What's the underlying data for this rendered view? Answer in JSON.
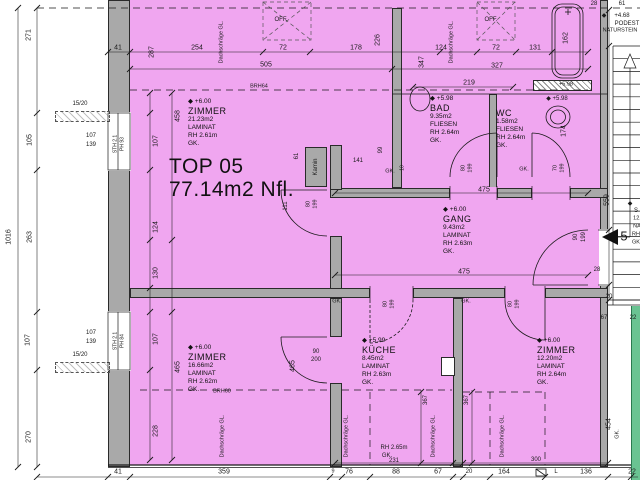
{
  "title": {
    "line1": "TOP 05",
    "line2": "77.14m2 Nfl."
  },
  "rooms": [
    {
      "id": "zimmer-nw",
      "level": "+6.00",
      "name": "ZIMMER",
      "area": "21.23m2",
      "floor": "LAMINAT",
      "rh": "RH 2.61m",
      "ceiling": "GK.",
      "x": 188,
      "y": 98
    },
    {
      "id": "bad",
      "level": "+5.98",
      "name": "BAD",
      "area": "9.35m2",
      "floor": "FLIESEN",
      "rh": "RH 2.64m",
      "ceiling": "GK.",
      "x": 430,
      "y": 95
    },
    {
      "id": "wc",
      "level": "",
      "name": "WC",
      "area": "1.58m2",
      "floor": "FLIESEN",
      "rh": "RH 2.64m",
      "ceiling": "GK.",
      "x": 496,
      "y": 108
    },
    {
      "id": "gang",
      "level": "+6.00",
      "name": "GANG",
      "area": "9.43m2",
      "floor": "LAMINAT",
      "rh": "RH 2.63m",
      "ceiling": "GK.",
      "x": 443,
      "y": 206
    },
    {
      "id": "zimmer-sw",
      "level": "+6.00",
      "name": "ZIMMER",
      "area": "16.66m2",
      "floor": "LAMINAT",
      "rh": "RH 2.62m",
      "ceiling": "GK.",
      "x": 188,
      "y": 344
    },
    {
      "id": "kueche",
      "level": "+5.99",
      "name": "KÜCHE",
      "area": "8.45m2",
      "floor": "LAMINAT",
      "rh": "RH 2.63m",
      "ceiling": "GK.",
      "x": 362,
      "y": 337
    },
    {
      "id": "zimmer-se",
      "level": "+6.00",
      "name": "ZIMMER",
      "area": "12.20m2",
      "floor": "LAMINAT",
      "rh": "RH 2.64m",
      "ceiling": "GK.",
      "x": 537,
      "y": 337
    }
  ],
  "stair": {
    "landing": "PODEST",
    "material": "NATURSTEIN",
    "level": "+4.68",
    "step_number": "5"
  },
  "colors": {
    "room_fill": "#f0a6f0",
    "wall": "#a9a9a9",
    "neighbor_strip": "#6ac392",
    "line": "#1a1a1a"
  },
  "labels": [
    {
      "t": "41",
      "x": 118,
      "y": 48
    },
    {
      "t": "287",
      "x": 152,
      "y": 52,
      "r": 1
    },
    {
      "t": "254",
      "x": 197,
      "y": 48
    },
    {
      "t": "72",
      "x": 283,
      "y": 48
    },
    {
      "t": "178",
      "x": 356,
      "y": 48
    },
    {
      "t": "226",
      "x": 378,
      "y": 40,
      "r": 1
    },
    {
      "t": "124",
      "x": 441,
      "y": 48
    },
    {
      "t": "72",
      "x": 496,
      "y": 48
    },
    {
      "t": "131",
      "x": 535,
      "y": 48
    },
    {
      "t": "505",
      "x": 266,
      "y": 65
    },
    {
      "t": "347",
      "x": 422,
      "y": 62,
      "r": 1
    },
    {
      "t": "327",
      "x": 497,
      "y": 66
    },
    {
      "t": "219",
      "x": 469,
      "y": 83
    },
    {
      "t": "28",
      "x": 594,
      "y": 4,
      "s": 6
    },
    {
      "t": "61",
      "x": 622,
      "y": 4,
      "s": 6
    },
    {
      "t": "162",
      "x": 566,
      "y": 38,
      "r": 1
    },
    {
      "t": "BRH64",
      "x": 259,
      "y": 87,
      "s": 5.5
    },
    {
      "t": "OFF.",
      "x": 281,
      "y": 20,
      "s": 6
    },
    {
      "t": "OFF.",
      "x": 491,
      "y": 20,
      "s": 6
    },
    {
      "t": "+5.98",
      "x": 566,
      "y": 85,
      "s": 5.5
    },
    {
      "t": "Dachschräge GL.",
      "x": 222,
      "y": 42,
      "r": 1,
      "s": 5.5
    },
    {
      "t": "Dachschräge GL.",
      "x": 452,
      "y": 42,
      "r": 1,
      "s": 5.5
    },
    {
      "t": "271",
      "x": 29,
      "y": 35,
      "r": 1
    },
    {
      "t": "105",
      "x": 30,
      "y": 140,
      "r": 1
    },
    {
      "t": "263",
      "x": 30,
      "y": 237,
      "r": 1
    },
    {
      "t": "107",
      "x": 28,
      "y": 340,
      "r": 1
    },
    {
      "t": "270",
      "x": 29,
      "y": 437,
      "r": 1
    },
    {
      "t": "1016",
      "x": 9,
      "y": 237,
      "r": 1
    },
    {
      "t": "15/20",
      "x": 80,
      "y": 104,
      "s": 6
    },
    {
      "t": "15/20",
      "x": 80,
      "y": 355,
      "s": 6
    },
    {
      "t": "107",
      "x": 91,
      "y": 136,
      "s": 6
    },
    {
      "t": "139",
      "x": 91,
      "y": 145,
      "s": 6
    },
    {
      "t": "107",
      "x": 91,
      "y": 333,
      "s": 6
    },
    {
      "t": "139",
      "x": 91,
      "y": 342,
      "s": 6
    },
    {
      "t": "STH 2.1",
      "x": 116,
      "y": 144,
      "r": 1,
      "s": 5
    },
    {
      "t": "PH 93",
      "x": 123,
      "y": 144,
      "r": 1,
      "s": 5
    },
    {
      "t": "STH 2.1",
      "x": 116,
      "y": 341,
      "r": 1,
      "s": 5
    },
    {
      "t": "PH 84",
      "x": 123,
      "y": 341,
      "r": 1,
      "s": 5
    },
    {
      "t": "458",
      "x": 178,
      "y": 116,
      "r": 1
    },
    {
      "t": "107",
      "x": 156,
      "y": 141,
      "r": 1
    },
    {
      "t": "124",
      "x": 156,
      "y": 227,
      "r": 1
    },
    {
      "t": "130",
      "x": 156,
      "y": 273,
      "r": 1
    },
    {
      "t": "107",
      "x": 156,
      "y": 339,
      "r": 1
    },
    {
      "t": "465",
      "x": 178,
      "y": 367,
      "r": 1
    },
    {
      "t": "228",
      "x": 156,
      "y": 431,
      "r": 1
    },
    {
      "t": "465",
      "x": 293,
      "y": 366,
      "r": 1
    },
    {
      "t": "Kamin",
      "x": 316,
      "y": 167,
      "r": 1,
      "s": 6
    },
    {
      "t": "61",
      "x": 297,
      "y": 156,
      "r": 1,
      "s": 6
    },
    {
      "t": "141",
      "x": 358,
      "y": 161,
      "s": 6
    },
    {
      "t": "99",
      "x": 381,
      "y": 150,
      "r": 1,
      "s": 6
    },
    {
      "t": "GK.",
      "x": 390,
      "y": 172,
      "s": 5.5
    },
    {
      "t": "111",
      "x": 286,
      "y": 206,
      "r": 1,
      "s": 6
    },
    {
      "t": "80",
      "x": 309,
      "y": 204,
      "r": 1,
      "s": 5.5
    },
    {
      "t": "199",
      "x": 316,
      "y": 204,
      "r": 1,
      "s": 5.5
    },
    {
      "t": "GK.",
      "x": 524,
      "y": 170,
      "s": 5.5
    },
    {
      "t": "10",
      "x": 403,
      "y": 168,
      "r": 1,
      "s": 5
    },
    {
      "t": "80",
      "x": 464,
      "y": 168,
      "r": 1,
      "s": 5.5
    },
    {
      "t": "199",
      "x": 471,
      "y": 168,
      "r": 1,
      "s": 5.5
    },
    {
      "t": "70",
      "x": 556,
      "y": 168,
      "r": 1,
      "s": 5.5
    },
    {
      "t": "199",
      "x": 563,
      "y": 168,
      "r": 1,
      "s": 5.5
    },
    {
      "t": "174",
      "x": 564,
      "y": 131,
      "r": 1
    },
    {
      "t": "◆ +5.98",
      "x": 557,
      "y": 99,
      "s": 6
    },
    {
      "t": "475",
      "x": 484,
      "y": 190
    },
    {
      "t": "475",
      "x": 464,
      "y": 272
    },
    {
      "t": "90",
      "x": 576,
      "y": 237,
      "r": 1,
      "s": 6
    },
    {
      "t": "199",
      "x": 584,
      "y": 237,
      "r": 1,
      "s": 6
    },
    {
      "t": "GK.",
      "x": 337,
      "y": 302,
      "s": 5.5
    },
    {
      "t": "GK.",
      "x": 466,
      "y": 302,
      "s": 5.5
    },
    {
      "t": "80",
      "x": 386,
      "y": 304,
      "r": 1,
      "s": 5.5
    },
    {
      "t": "199",
      "x": 393,
      "y": 304,
      "r": 1,
      "s": 5.5
    },
    {
      "t": "80",
      "x": 511,
      "y": 304,
      "r": 1,
      "s": 5.5
    },
    {
      "t": "199",
      "x": 518,
      "y": 304,
      "r": 1,
      "s": 5.5
    },
    {
      "t": "90",
      "x": 316,
      "y": 352,
      "s": 6
    },
    {
      "t": "200",
      "x": 316,
      "y": 360,
      "s": 6
    },
    {
      "t": "367",
      "x": 426,
      "y": 400,
      "r": 1,
      "s": 6
    },
    {
      "t": "367",
      "x": 467,
      "y": 400,
      "r": 1,
      "s": 6
    },
    {
      "t": "RH 2.65m",
      "x": 394,
      "y": 448,
      "s": 6
    },
    {
      "t": "GK.",
      "x": 387,
      "y": 456,
      "s": 6
    },
    {
      "t": "231",
      "x": 394,
      "y": 461,
      "s": 6
    },
    {
      "t": "300",
      "x": 536,
      "y": 460,
      "s": 6
    },
    {
      "t": "454",
      "x": 609,
      "y": 424,
      "r": 1
    },
    {
      "t": "GK.",
      "x": 618,
      "y": 434,
      "r": 1,
      "s": 5.5
    },
    {
      "t": "BRH60",
      "x": 222,
      "y": 392,
      "s": 5.5
    },
    {
      "t": "Dachschräge GL.",
      "x": 223,
      "y": 436,
      "r": 1,
      "s": 5.5
    },
    {
      "t": "Dachschräge GL.",
      "x": 347,
      "y": 436,
      "r": 1,
      "s": 5.5
    },
    {
      "t": "Dachschräge GL.",
      "x": 434,
      "y": 436,
      "r": 1,
      "s": 5.5
    },
    {
      "t": "Dachschräge GL.",
      "x": 503,
      "y": 436,
      "r": 1,
      "s": 5.5
    },
    {
      "t": "41",
      "x": 118,
      "y": 472
    },
    {
      "t": "359",
      "x": 224,
      "y": 472
    },
    {
      "t": "9",
      "x": 333,
      "y": 472,
      "s": 5.5
    },
    {
      "t": "76",
      "x": 349,
      "y": 472
    },
    {
      "t": "88",
      "x": 396,
      "y": 472
    },
    {
      "t": "67",
      "x": 438,
      "y": 472
    },
    {
      "t": "20",
      "x": 469,
      "y": 472,
      "s": 6
    },
    {
      "t": "164",
      "x": 504,
      "y": 472
    },
    {
      "t": "L",
      "x": 556,
      "y": 472,
      "s": 6
    },
    {
      "t": "136",
      "x": 586,
      "y": 472
    },
    {
      "t": "22",
      "x": 632,
      "y": 472
    },
    {
      "t": "559",
      "x": 607,
      "y": 200,
      "r": 1
    },
    {
      "t": "28",
      "x": 597,
      "y": 270,
      "s": 6
    },
    {
      "t": "20",
      "x": 609,
      "y": 297,
      "s": 6
    },
    {
      "t": "67",
      "x": 604,
      "y": 318,
      "s": 6
    },
    {
      "t": "22",
      "x": 633,
      "y": 318,
      "s": 6
    },
    {
      "t": "5",
      "x": 624,
      "y": 236,
      "s": 13
    },
    {
      "t": "◆",
      "x": 604,
      "y": 16,
      "s": 6
    },
    {
      "t": "+4.68",
      "x": 622,
      "y": 16,
      "s": 6
    },
    {
      "t": "PODEST",
      "x": 627,
      "y": 24,
      "s": 6
    },
    {
      "t": "NATURSTEIN",
      "x": 620,
      "y": 31,
      "s": 5.5
    },
    {
      "t": "◆",
      "x": 630,
      "y": 204,
      "s": 6
    },
    {
      "t": "S",
      "x": 636,
      "y": 211,
      "s": 6
    },
    {
      "t": "12.",
      "x": 637,
      "y": 219,
      "s": 5.5
    },
    {
      "t": "NA",
      "x": 637,
      "y": 227,
      "s": 5.5
    },
    {
      "t": "RH",
      "x": 636,
      "y": 235,
      "s": 5.5
    },
    {
      "t": "GK",
      "x": 636,
      "y": 243,
      "s": 5.5
    }
  ]
}
